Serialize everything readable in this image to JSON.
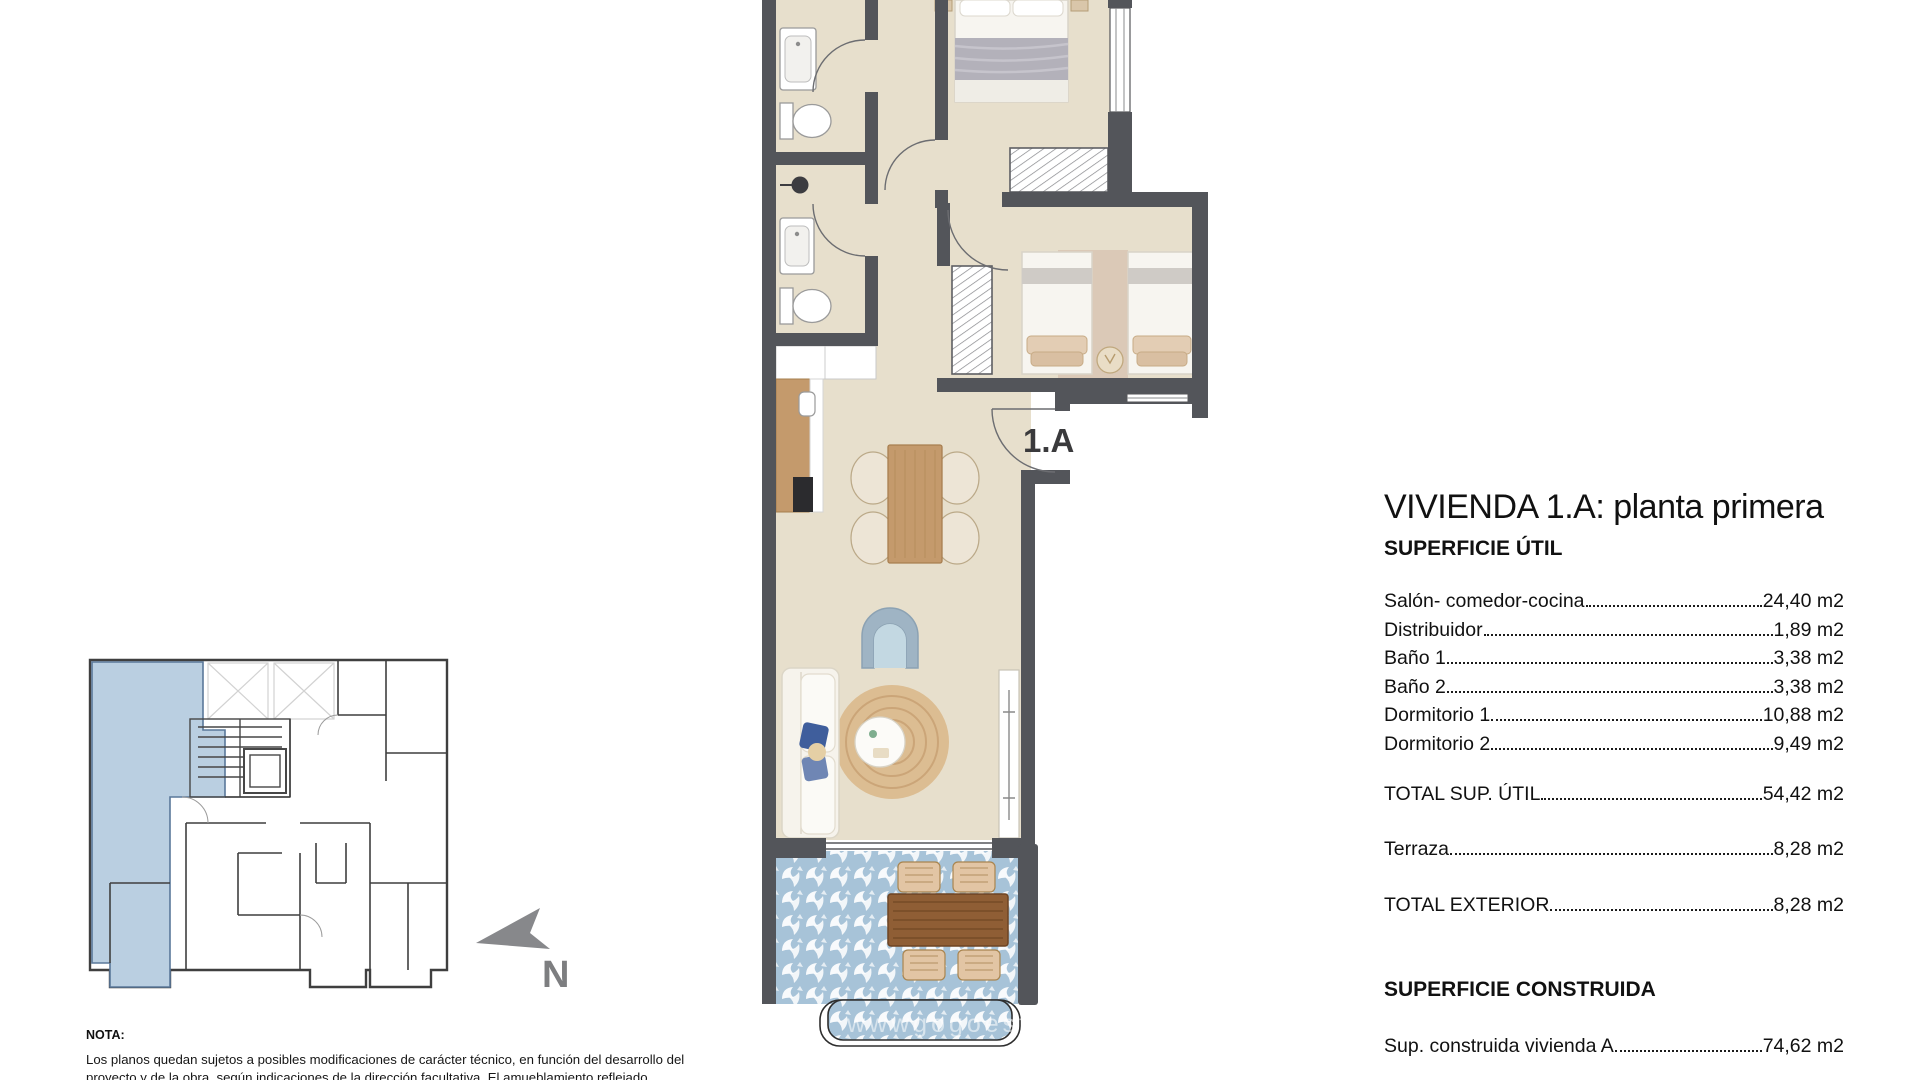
{
  "header": {
    "title": "VIVIENDA 1.A: planta primera"
  },
  "sections": {
    "superficie_util": {
      "heading": "SUPERFICIE ÚTIL",
      "rows": [
        {
          "label": "Salón- comedor-cocina",
          "value": "24,40 m2"
        },
        {
          "label": "Distribuidor",
          "value": "1,89 m2"
        },
        {
          "label": "Baño 1",
          "value": "3,38 m2"
        },
        {
          "label": "Baño 2",
          "value": "3,38 m2"
        },
        {
          "label": "Dormitorio 1",
          "value": "10,88 m2"
        },
        {
          "label": "Dormitorio 2",
          "value": "9,49 m2"
        }
      ],
      "total": {
        "label": "TOTAL SUP. ÚTIL",
        "value": "54,42 m2"
      },
      "terraza": {
        "label": "Terraza",
        "value": "8,28 m2"
      },
      "total_exterior": {
        "label": "TOTAL EXTERIOR",
        "value": "8,28 m2"
      }
    },
    "superficie_construida": {
      "heading": "SUPERFICIE CONSTRUIDA",
      "row": {
        "label": "Sup. construida vivienda A",
        "value": "74,62 m2"
      }
    }
  },
  "plan": {
    "unit_label": "1.A",
    "watermark": "wwwgogoestu"
  },
  "north": {
    "label": "N"
  },
  "nota": {
    "heading": "NOTA:",
    "body": "Los planos quedan sujetos a posibles modificaciones de carácter técnico, en función del desarrollo del proyecto y de la obra, según indicaciones de la dirección facultativa. El amueblamiento reflejado"
  },
  "colors": {
    "wall": "#53555A",
    "floor": "#E7DFCC",
    "terrace_tile": "#A7C3D8",
    "keyplan_unit": "#BACFE1",
    "wood": "#C49A6C",
    "terrace_wood": "#8F5E35",
    "rug": "#DCBD92",
    "armchair": "#B5CBD9",
    "pillow": "#3F5E9C",
    "north_arrow": "#87888B"
  }
}
